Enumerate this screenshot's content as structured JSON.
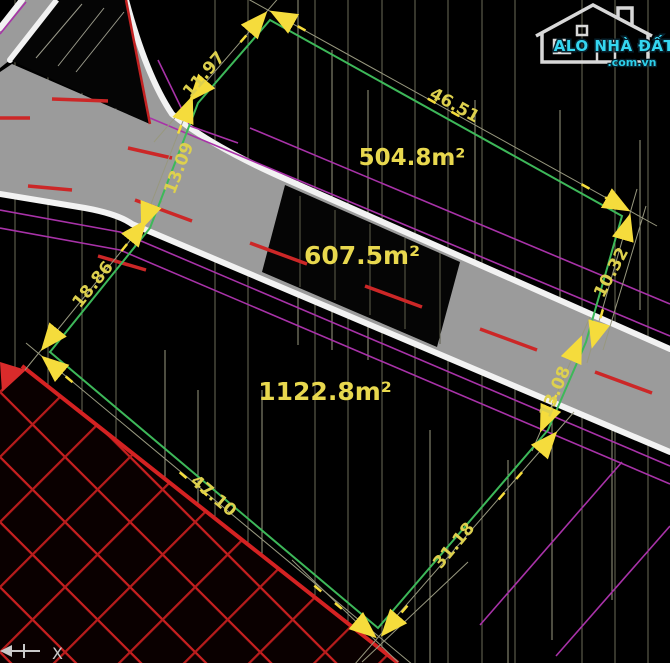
{
  "watermark": {
    "brand": "ALO NHÀ ĐẤT",
    "domain": ".com.vn"
  },
  "parcels": {
    "top": {
      "area": "504.8m²"
    },
    "middle": {
      "area": "607.5m²"
    },
    "bottom": {
      "area": "1122.8m²"
    }
  },
  "dimensions": {
    "top_left_edge": "11.97",
    "road_crossing_left": "13.09",
    "left_edge": "18.86",
    "bottom_left_edge": "47.10",
    "bottom_right_edge": "31.18",
    "road_crossing_right": "13.08",
    "right_edge": "10.32",
    "top_right_edge": "46.51"
  },
  "ucs": {
    "x_label": "X"
  },
  "colors": {
    "dimension_text": "#ddd04e",
    "area_text": "#e8d84e",
    "boundary_green": "#3db859",
    "parcel_purple": "#a832a8",
    "road_marking_red": "#cc2727",
    "hatch_red": "#c92020",
    "brand_cyan": "#35d6f0"
  }
}
